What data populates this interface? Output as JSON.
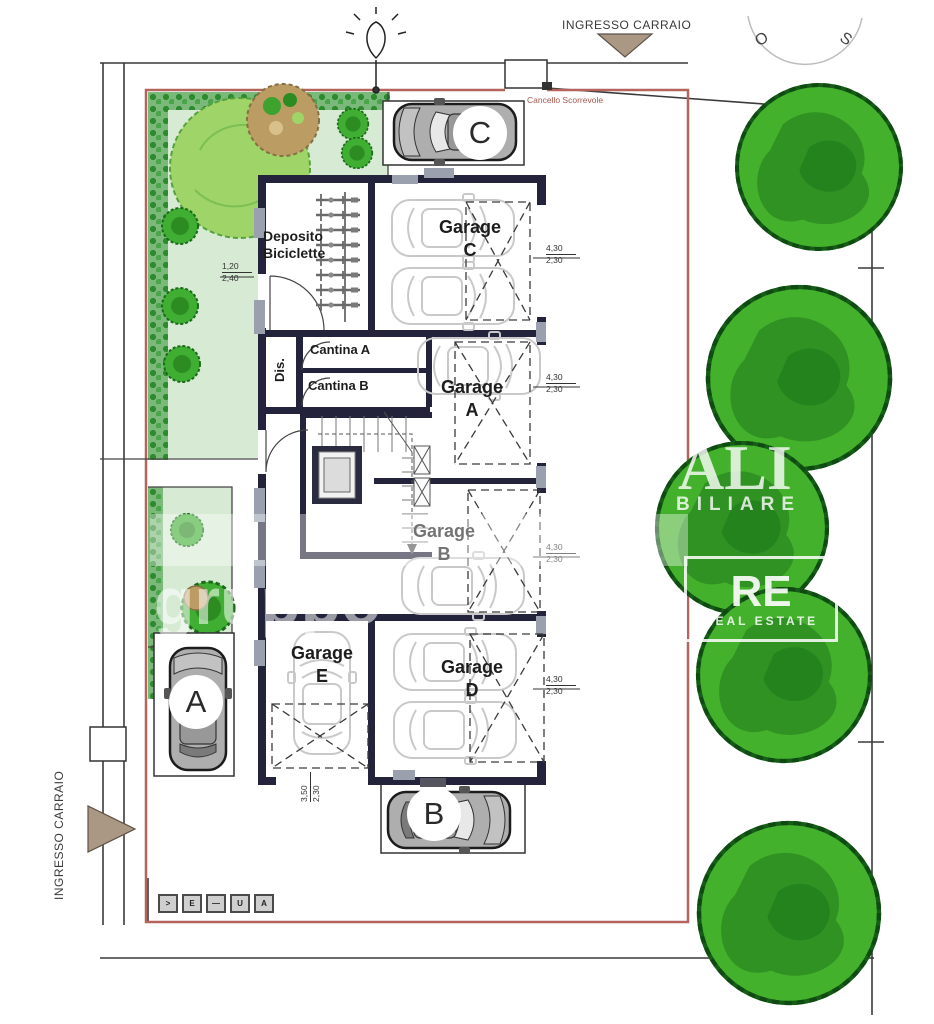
{
  "labels": {
    "ingresso_top": "INGRESSO CARRAIO",
    "ingresso_left": "INGRESSO CARRAIO",
    "cancello": "Cancello Scorrevole",
    "compass": {
      "west": "O",
      "south": "S"
    }
  },
  "rooms": {
    "deposito_line1": "Deposito",
    "deposito_line2": "Biciclette",
    "cantina_a": "Cantina A",
    "cantina_b": "Cantina B",
    "dis": "Dis.",
    "garage_word": "Garage",
    "garage_c": "C",
    "garage_a": "A",
    "garage_b": "B",
    "garage_d": "D",
    "garage_e": "E"
  },
  "parking": {
    "a": "A",
    "b": "B",
    "c": "C"
  },
  "dims": {
    "garage_c": {
      "w": "4,30",
      "h": "2,30"
    },
    "garage_a": {
      "w": "4,30",
      "h": "2,30"
    },
    "garage_b": {
      "w": "4,30",
      "h": "2,30"
    },
    "garage_d": {
      "w": "4,30",
      "h": "2,30"
    },
    "garage_e": {
      "w": "3,50",
      "h": "2,30"
    },
    "window": {
      "w": "1,20",
      "h": "2,40"
    }
  },
  "watermark": {
    "word_end": "ALI",
    "line2": "BILIARE",
    "gruppo": "gruppo",
    "re": "RE",
    "real_estate": "REAL ESTATE"
  },
  "legend": [
    ">",
    "E",
    "—",
    "U",
    "A"
  ],
  "colors": {
    "boundary_red": "#b4645a",
    "wall_dark": "#23233b",
    "garden_light": "#d7ebd4",
    "hedge_green": "#2e8a2e",
    "tree_green": "#44b12c",
    "tree_shade": "#2e8f22",
    "arrow_tan": "#ab9884",
    "ghost_car": "#c9c9c9"
  }
}
